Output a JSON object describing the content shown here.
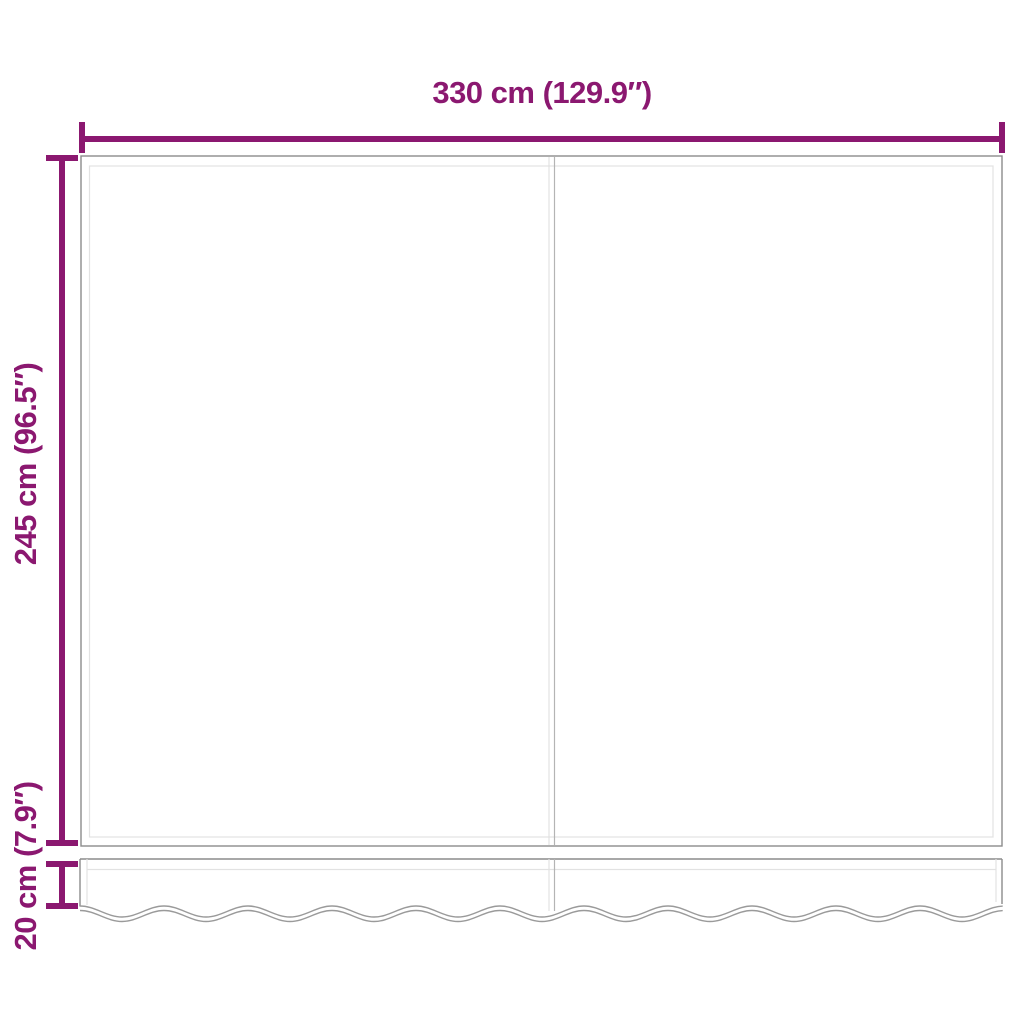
{
  "diagram": {
    "dimensions": {
      "width_label": "330 cm (129.9″)",
      "height_label": "245 cm (96.5″)",
      "valance_height_label": "20 cm (7.9″)"
    },
    "colors": {
      "accent": "#8B1870",
      "outline": "#8C8C8C",
      "inner": "#E2E2E2",
      "seam": "#B4B4B4",
      "wave": "#9A9A9A",
      "background": "#FFFFFF"
    }
  }
}
